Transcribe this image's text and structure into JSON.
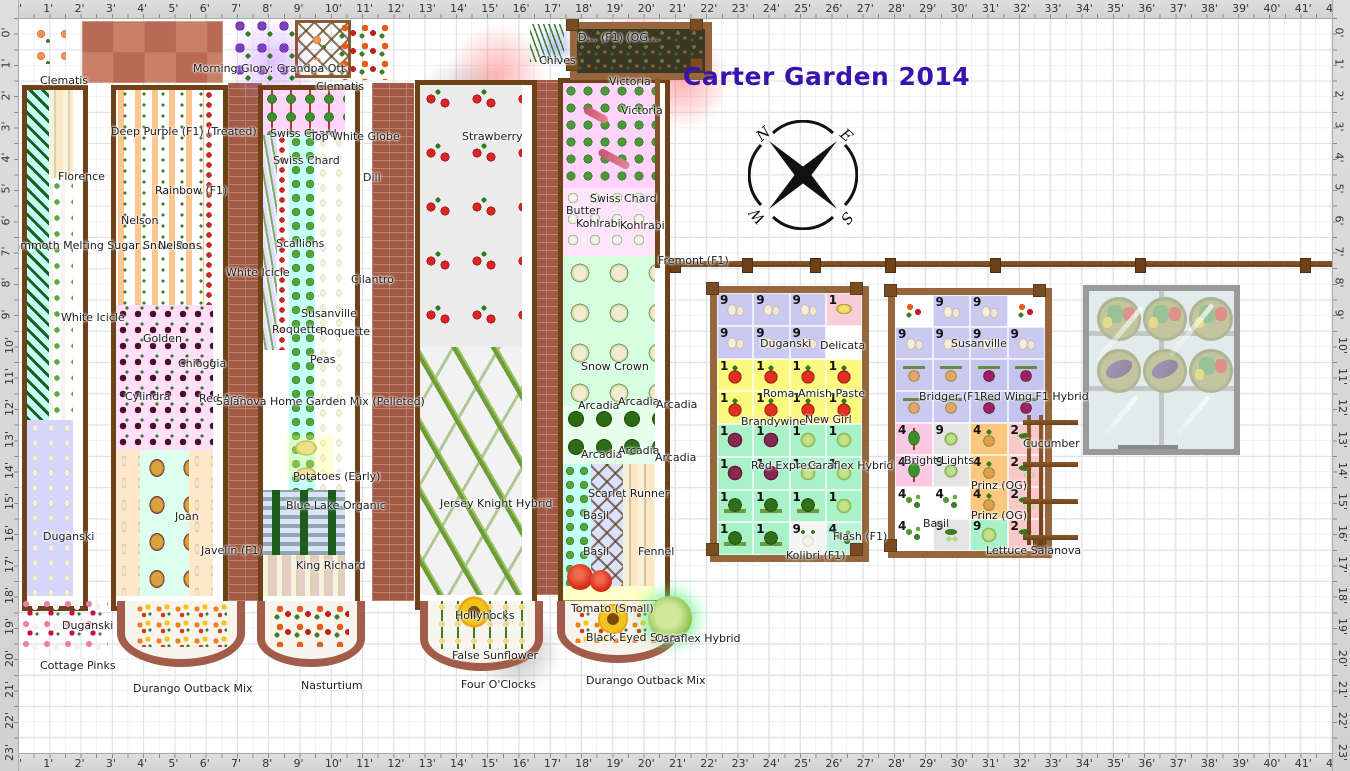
{
  "title": "Carter Garden 2014",
  "rulers": {
    "unit": "'",
    "top": {
      "start": 0,
      "end": 42
    },
    "bottom": {
      "start": 0,
      "end": 42
    },
    "left": {
      "start": 0,
      "end": 23
    },
    "right": {
      "start": 0,
      "end": 23
    }
  },
  "compass": {
    "letters": [
      "N",
      "E",
      "W",
      "S"
    ]
  },
  "colors": {
    "title": "#3813ad",
    "bed_border": "#6e4118",
    "frame_wood": "#96663c",
    "brick": "#a05a46",
    "ruler_bg": "#d6d6d6",
    "cell_garlic": "#c9c9f2",
    "cell_tomato": "#fafa7e",
    "cell_brassica": "#a9f2c9",
    "cell_turnip": "#f9c87e",
    "cell_chard": "#f9c9e3",
    "cell_cucumber": "#f9c9c9"
  },
  "labels": [
    {
      "text": "Clematis",
      "x": 22,
      "y": 56
    },
    {
      "text": "Morning Glory: Grandpa Ott",
      "x": 175,
      "y": 44
    },
    {
      "text": "Clematis",
      "x": 298,
      "y": 62
    },
    {
      "text": "Chives",
      "x": 521,
      "y": 36
    },
    {
      "text": "D… (F1) (OG…",
      "x": 560,
      "y": 13
    },
    {
      "text": "Victoria",
      "x": 591,
      "y": 57
    },
    {
      "text": "Victoria",
      "x": 603,
      "y": 86
    },
    {
      "text": "Deep Purple (F1) (Treated)",
      "x": 93,
      "y": 107
    },
    {
      "text": "Swiss Chard",
      "x": 252,
      "y": 109
    },
    {
      "text": "Top White Globe",
      "x": 292,
      "y": 112
    },
    {
      "text": "Swiss Chard",
      "x": 255,
      "y": 136
    },
    {
      "text": "Rainbow (F1)",
      "x": 137,
      "y": 166
    },
    {
      "text": "Nelson",
      "x": 103,
      "y": 196
    },
    {
      "text": "Mammoth Melting Sugar Snow Peas",
      "x": -14,
      "y": 221
    },
    {
      "text": "Nelson",
      "x": 140,
      "y": 221
    },
    {
      "text": "Florence",
      "x": 40,
      "y": 152
    },
    {
      "text": "Dill",
      "x": 345,
      "y": 153
    },
    {
      "text": "White Icicle",
      "x": 208,
      "y": 248
    },
    {
      "text": "Scallions",
      "x": 258,
      "y": 219
    },
    {
      "text": "Cilantro",
      "x": 333,
      "y": 255
    },
    {
      "text": "White Icicle",
      "x": 43,
      "y": 293
    },
    {
      "text": "Susanville",
      "x": 283,
      "y": 289
    },
    {
      "text": "Roquette",
      "x": 254,
      "y": 305
    },
    {
      "text": "Roquette",
      "x": 302,
      "y": 307
    },
    {
      "text": "Peas",
      "x": 292,
      "y": 335
    },
    {
      "text": "Golden",
      "x": 125,
      "y": 314
    },
    {
      "text": "Chioggia",
      "x": 160,
      "y": 339
    },
    {
      "text": "Cylindra",
      "x": 107,
      "y": 372
    },
    {
      "text": "Red Ace",
      "x": 181,
      "y": 374
    },
    {
      "text": "Salanova Home Garden Mix (Pelleted)",
      "x": 198,
      "y": 377
    },
    {
      "text": "Potatoes (Early)",
      "x": 275,
      "y": 452
    },
    {
      "text": "Blue Lake Organic",
      "x": 268,
      "y": 481
    },
    {
      "text": "King Richard",
      "x": 278,
      "y": 541
    },
    {
      "text": "Joan",
      "x": 157,
      "y": 492
    },
    {
      "text": "Javelin (F1)",
      "x": 183,
      "y": 526
    },
    {
      "text": "Duganski",
      "x": 25,
      "y": 512
    },
    {
      "text": "Duganski",
      "x": 44,
      "y": 601
    },
    {
      "text": "Cottage Pinks",
      "x": 22,
      "y": 641
    },
    {
      "text": "Durango Outback Mix",
      "x": 115,
      "y": 664
    },
    {
      "text": "Nasturtium",
      "x": 283,
      "y": 661
    },
    {
      "text": "Strawberry",
      "x": 444,
      "y": 112
    },
    {
      "text": "Jersey Knight Hybrid",
      "x": 422,
      "y": 479
    },
    {
      "text": "Hollyhocks",
      "x": 437,
      "y": 591
    },
    {
      "text": "False Sunflower",
      "x": 434,
      "y": 631
    },
    {
      "text": "Four O'Clocks",
      "x": 443,
      "y": 660
    },
    {
      "text": "Swiss Chard",
      "x": 572,
      "y": 174
    },
    {
      "text": "Butter",
      "x": 548,
      "y": 186
    },
    {
      "text": "Kohlrabi",
      "x": 558,
      "y": 199
    },
    {
      "text": "Kohlrabi",
      "x": 602,
      "y": 201
    },
    {
      "text": "Fremont (F1)",
      "x": 640,
      "y": 236
    },
    {
      "text": "Snow Crown",
      "x": 563,
      "y": 342
    },
    {
      "text": "Arcadia",
      "x": 560,
      "y": 381
    },
    {
      "text": "Arcadia",
      "x": 600,
      "y": 377
    },
    {
      "text": "Arcadia",
      "x": 638,
      "y": 380
    },
    {
      "text": "Arcadia",
      "x": 563,
      "y": 430
    },
    {
      "text": "Arcadia",
      "x": 600,
      "y": 426
    },
    {
      "text": "Arcadia",
      "x": 637,
      "y": 433
    },
    {
      "text": "Scarlet Runner",
      "x": 570,
      "y": 469
    },
    {
      "text": "Basil",
      "x": 565,
      "y": 491
    },
    {
      "text": "Basil",
      "x": 565,
      "y": 527
    },
    {
      "text": "Fennel",
      "x": 620,
      "y": 527
    },
    {
      "text": "Tomato (Small)",
      "x": 553,
      "y": 584
    },
    {
      "text": "Black Eyed Susan",
      "x": 568,
      "y": 613
    },
    {
      "text": "Caraflex Hybrid",
      "x": 637,
      "y": 614
    },
    {
      "text": "Durango Outback Mix",
      "x": 568,
      "y": 656
    },
    {
      "text": "Duganski",
      "x": 742,
      "y": 319
    },
    {
      "text": "Delicata",
      "x": 802,
      "y": 321
    },
    {
      "text": "Roma",
      "x": 745,
      "y": 369
    },
    {
      "text": "Amish Paste",
      "x": 780,
      "y": 369
    },
    {
      "text": "Brandywine",
      "x": 723,
      "y": 397
    },
    {
      "text": "New Girl",
      "x": 787,
      "y": 395
    },
    {
      "text": "Red Express",
      "x": 733,
      "y": 441
    },
    {
      "text": "Caraflex Hybrid",
      "x": 790,
      "y": 441
    },
    {
      "text": "Flash (F1)",
      "x": 815,
      "y": 512
    },
    {
      "text": "Kolibri (F1)",
      "x": 768,
      "y": 531
    },
    {
      "text": "Susanville",
      "x": 933,
      "y": 319
    },
    {
      "text": "Bridger (F1)",
      "x": 901,
      "y": 372
    },
    {
      "text": "Red Wing F1 Hybrid",
      "x": 962,
      "y": 372
    },
    {
      "text": "Bright Lights",
      "x": 886,
      "y": 436
    },
    {
      "text": "Cucumber",
      "x": 1005,
      "y": 419
    },
    {
      "text": "Prinz (OG)",
      "x": 953,
      "y": 461
    },
    {
      "text": "Prinz (OG)",
      "x": 953,
      "y": 491
    },
    {
      "text": "Basil",
      "x": 905,
      "y": 499
    },
    {
      "text": "Lettuce Salanova",
      "x": 968,
      "y": 526
    }
  ],
  "sqft_bed_a": {
    "x": 710,
    "y": 286,
    "w": 145,
    "h": 262,
    "rows": [
      [
        {
          "n": "9",
          "c": "garlic"
        },
        {
          "n": "9",
          "c": "garlic"
        },
        {
          "n": "9",
          "c": "garlic"
        },
        {
          "n": "1",
          "c": "delicata"
        }
      ],
      [
        {
          "n": "9",
          "c": "garlic"
        },
        {
          "n": "9",
          "c": "garlic"
        },
        {
          "n": "9",
          "c": "garlic"
        },
        {
          "n": "",
          "c": "empty"
        }
      ],
      [
        {
          "n": "1",
          "c": "tomato"
        },
        {
          "n": "1",
          "c": "tomato"
        },
        {
          "n": "1",
          "c": "tomato"
        },
        {
          "n": "1",
          "c": "tomato"
        }
      ],
      [
        {
          "n": "1",
          "c": "tomato"
        },
        {
          "n": "1",
          "c": "tomato"
        },
        {
          "n": "1",
          "c": "tomato"
        },
        {
          "n": "1",
          "c": "tomato"
        }
      ],
      [
        {
          "n": "1",
          "c": "redcab"
        },
        {
          "n": "1",
          "c": "redcab"
        },
        {
          "n": "1",
          "c": "cabbage"
        },
        {
          "n": "1",
          "c": "cabbage"
        }
      ],
      [
        {
          "n": "1",
          "c": "redcab"
        },
        {
          "n": "1",
          "c": "redcab"
        },
        {
          "n": "1",
          "c": "cabbage"
        },
        {
          "n": "1",
          "c": "cabbage"
        }
      ],
      [
        {
          "n": "1",
          "c": "broccoli"
        },
        {
          "n": "1",
          "c": "broccoli"
        },
        {
          "n": "1",
          "c": "broccoli"
        },
        {
          "n": "1",
          "c": "cabbage"
        }
      ],
      [
        {
          "n": "1",
          "c": "broccoli"
        },
        {
          "n": "1",
          "c": "broccoli"
        },
        {
          "n": "9",
          "c": "kohlrabi"
        },
        {
          "n": "4",
          "c": "flash"
        }
      ]
    ]
  },
  "sqft_bed_b": {
    "x": 888,
    "y": 288,
    "w": 150,
    "h": 256,
    "rows": [
      [
        {
          "n": "",
          "c": "flower"
        },
        {
          "n": "9",
          "c": "garlic"
        },
        {
          "n": "9",
          "c": "garlic"
        },
        {
          "n": "",
          "c": "flower"
        }
      ],
      [
        {
          "n": "9",
          "c": "garlic"
        },
        {
          "n": "9",
          "c": "garlic"
        },
        {
          "n": "9",
          "c": "garlic"
        },
        {
          "n": "9",
          "c": "garlic"
        }
      ],
      [
        {
          "n": "",
          "c": "onion"
        },
        {
          "n": "",
          "c": "onion"
        },
        {
          "n": "",
          "c": "redonion"
        },
        {
          "n": "",
          "c": "redonion"
        }
      ],
      [
        {
          "n": "",
          "c": "onion"
        },
        {
          "n": "",
          "c": "onion"
        },
        {
          "n": "",
          "c": "redonion"
        },
        {
          "n": "",
          "c": "redonion"
        }
      ],
      [
        {
          "n": "4",
          "c": "chard"
        },
        {
          "n": "9",
          "c": "lettuce"
        },
        {
          "n": "4",
          "c": "turnip"
        },
        {
          "n": "2",
          "c": "cucumber"
        }
      ],
      [
        {
          "n": "4",
          "c": "chard"
        },
        {
          "n": "9",
          "c": "lettuce"
        },
        {
          "n": "4",
          "c": "turnip"
        },
        {
          "n": "2",
          "c": "cucumber"
        }
      ],
      [
        {
          "n": "4",
          "c": "basil"
        },
        {
          "n": "4",
          "c": "basil"
        },
        {
          "n": "4",
          "c": "turnip"
        },
        {
          "n": "2",
          "c": "cucumber"
        }
      ],
      [
        {
          "n": "4",
          "c": "basil"
        },
        {
          "n": "9",
          "c": "peas"
        },
        {
          "n": "9",
          "c": "cabbage"
        },
        {
          "n": "2",
          "c": "cucumber"
        }
      ]
    ]
  },
  "fence": {
    "rail_y": 261,
    "x1": 658,
    "x2": 1314,
    "posts": [
      652,
      724,
      792,
      867,
      972,
      1117,
      1282
    ]
  },
  "coldframe": {
    "pots": [
      "pepper",
      "pepper",
      "pepper",
      "eggplant",
      "eggplant",
      "pepper"
    ]
  }
}
